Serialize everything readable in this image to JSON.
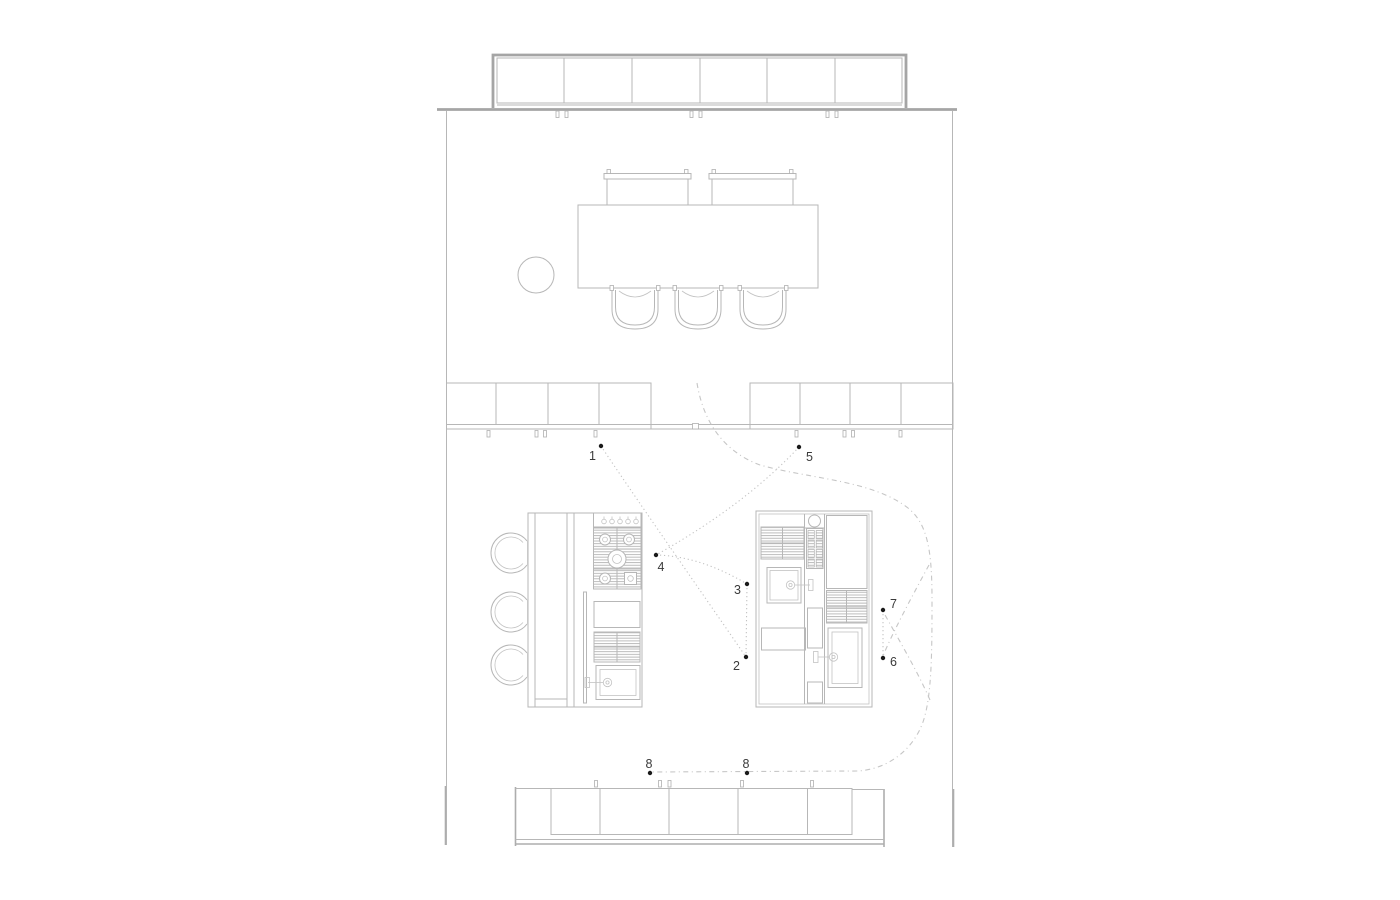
{
  "drawing": {
    "type": "architectural-floor-plan",
    "subject": "kitchen floor plan with numbered annotation points",
    "background_color": "#ffffff",
    "colors": {
      "wall": "#a5a5a5",
      "line": "#b7b7b7",
      "hatch": "#b5b5b5",
      "leader_dotted": "#c2c2c2",
      "leader_dashed": "#c6c6c6",
      "annotation_dot": "#1a1a1a",
      "annotation_label": "#3a3a3a"
    }
  },
  "annotations": {
    "points": [
      {
        "label": "1",
        "x": 601,
        "y": 446,
        "label_x": 596,
        "label_y": 460
      },
      {
        "label": "5",
        "x": 799,
        "y": 447,
        "label_x": 806,
        "label_y": 461
      },
      {
        "label": "4",
        "x": 656,
        "y": 555,
        "label_x": 661,
        "label_y": 571
      },
      {
        "label": "3",
        "x": 747,
        "y": 584,
        "label_x": 741,
        "label_y": 594
      },
      {
        "label": "2",
        "x": 746,
        "y": 657,
        "label_x": 740,
        "label_y": 670
      },
      {
        "label": "7",
        "x": 883,
        "y": 610,
        "label_x": 890,
        "label_y": 608
      },
      {
        "label": "6",
        "x": 883,
        "y": 658,
        "label_x": 890,
        "label_y": 666
      },
      {
        "label": "8",
        "x": 650,
        "y": 773,
        "label_x": 649,
        "label_y": 768
      },
      {
        "label": "8",
        "x": 747,
        "y": 773,
        "label_x": 746,
        "label_y": 768
      }
    ],
    "leader_lines": [
      {
        "from": "1",
        "to": "2",
        "style": "dotted"
      },
      {
        "from": "5",
        "to": "4",
        "style": "dotted"
      },
      {
        "from": "4",
        "to": "3",
        "style": "dotted"
      },
      {
        "from": "3",
        "to": "2",
        "style": "dotted"
      },
      {
        "from": "7",
        "to": "6",
        "style": "dotted"
      },
      {
        "from": "door-opening",
        "to": "8-8",
        "style": "dash-dot"
      },
      {
        "from": "route",
        "to": "6",
        "style": "dash-dot"
      },
      {
        "from": "route",
        "to": "7",
        "style": "dash-dot"
      }
    ]
  },
  "fixtures": {
    "top": "wall cabinet row, 6 doors",
    "dining": "dining table with 2 benches and 3 chairs, round side table",
    "middle": "two sideboard runs (4 doors each) flanking a door opening",
    "island": "kitchen island: bar counter, 3 stools, 5-burner gas hob with knobs, base cabinet, vent grille, sink with faucet",
    "right_unit": "kitchen block: vent grilles, round hob, oven stack, two sinks with faucets, tall cabinet",
    "bottom": "counter bay, 5 doors"
  }
}
